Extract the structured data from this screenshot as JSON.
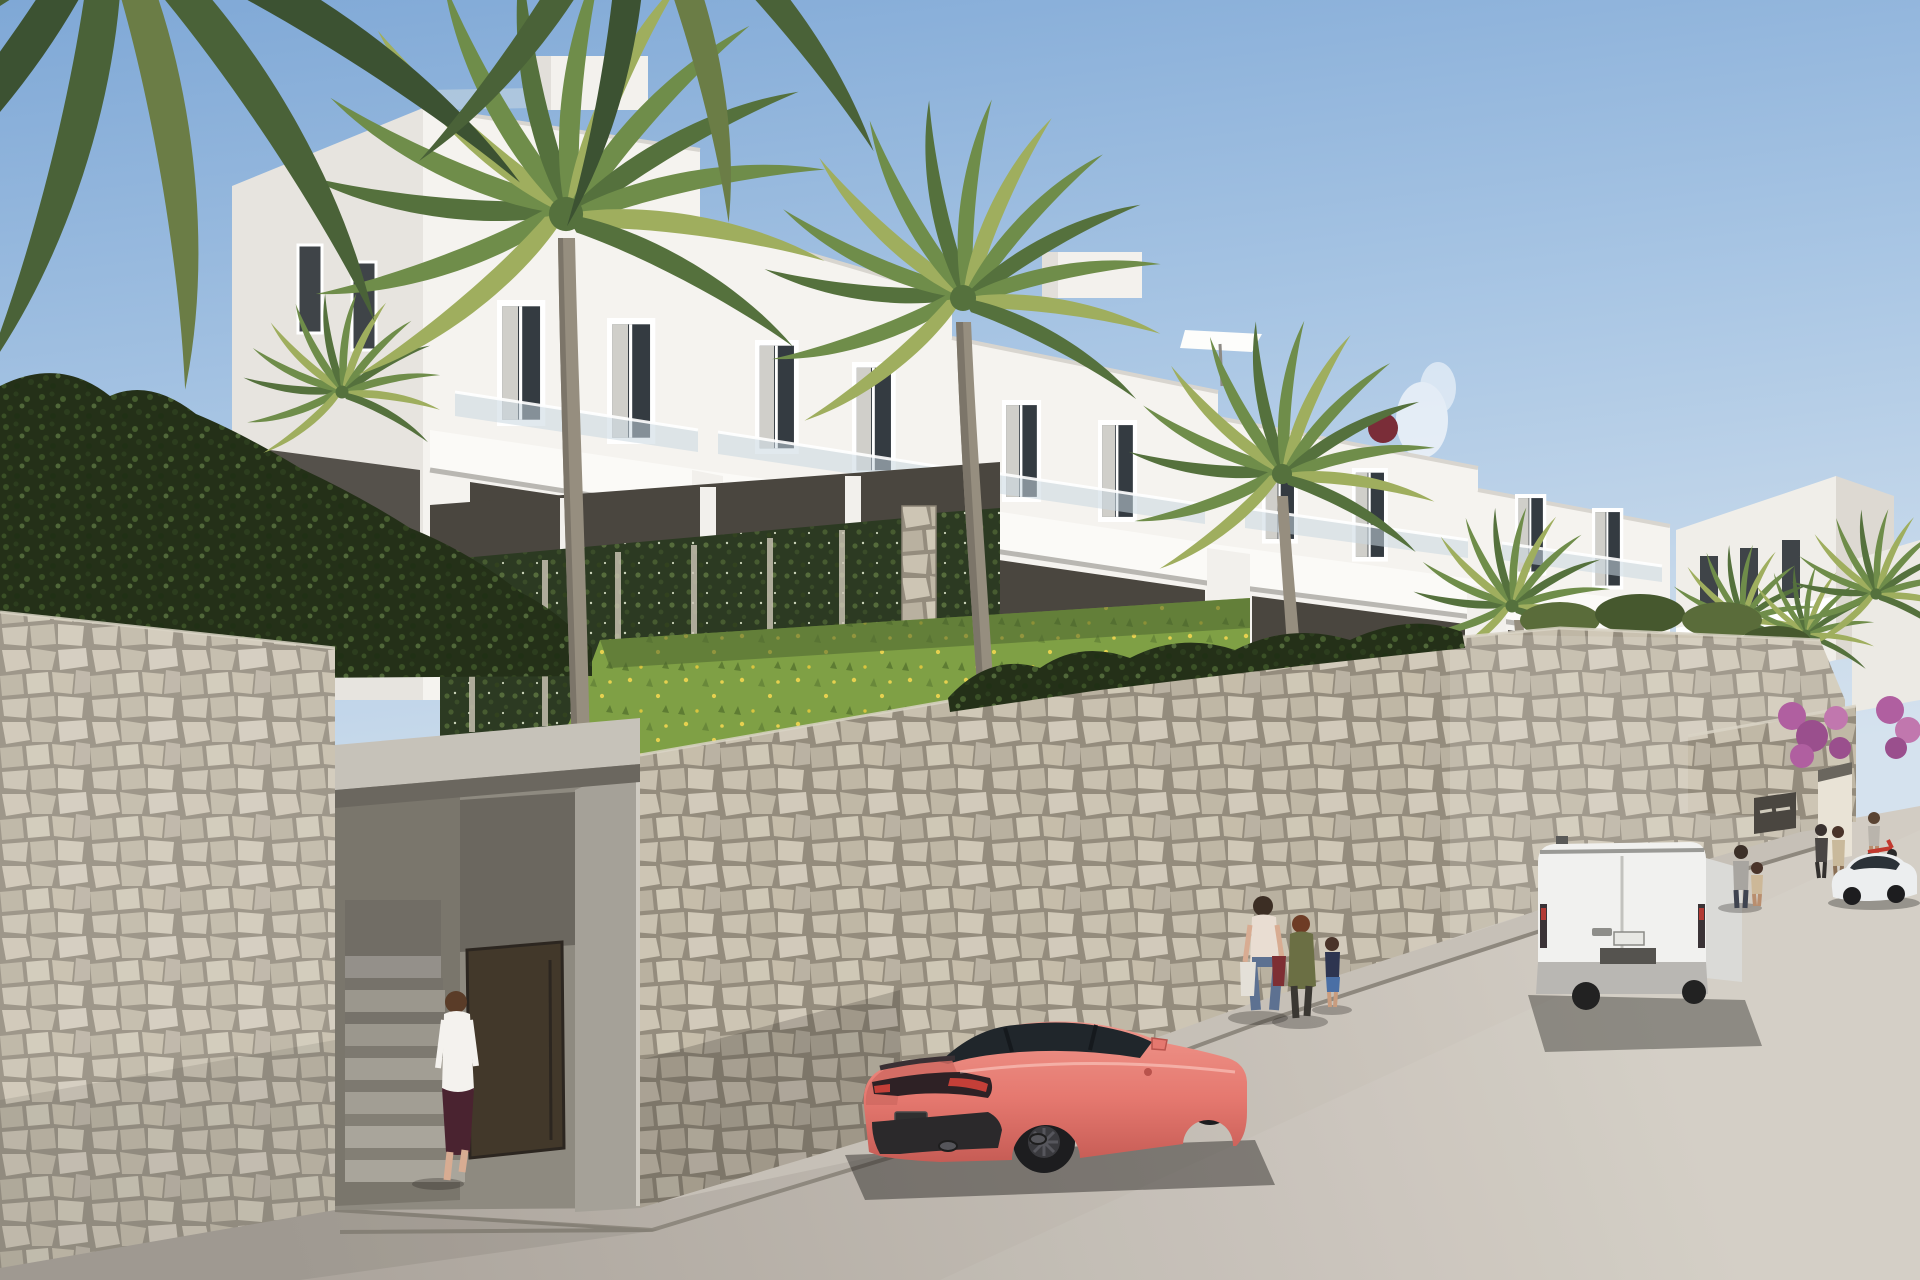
{
  "scene_type": "architectural-exterior-render",
  "colors": {
    "sky_top": "#7fa8d6",
    "sky_mid": "#a9c6e4",
    "sky_low": "#d5e2ee",
    "building_sun": "#f5f3ef",
    "building_shade": "#e7e4df",
    "building_recess": "#4a463f",
    "parapet": "#fbfaf7",
    "glass_balustrade": "#c9d7e0",
    "window_glass": "#343b41",
    "window_frame": "#ffffff",
    "curtain": "#eceae3",
    "stone_light": "#c9c1b0",
    "stone_grout": "#948c7d",
    "hedge": "#243018",
    "ivy": "#2c3a22",
    "grass": "#7fa045",
    "wildflower": "#e6d14f",
    "palm_green": "#6f8d4a",
    "palm_dark": "#4a6238",
    "palm_light": "#9fae5e",
    "palm_trunk": "#968e7f",
    "road_near": "#aba49c",
    "road_far": "#d2ccc3",
    "sidewalk": "#c6c0b7",
    "curb": "#8e887e",
    "car_body": "#ef978c",
    "car_body_dark": "#c55b54",
    "car_glass": "#20262b",
    "wheel": "#1d1d1f",
    "tail_light_red": "#c43f38",
    "van_body": "#f1f1ef",
    "van_side": "#dadad7",
    "van_bumper": "#b9b7b3",
    "sedan_body": "#eceeef",
    "door_brown": "#42382a",
    "bougainvillea": "#b05fa0",
    "scooter_red": "#c2392f",
    "skirt_maroon": "#4a2330",
    "jeans_blue": "#5d7191",
    "jacket_olive": "#6b6f44",
    "shorts_blue": "#4a6fa5"
  },
  "objects": {
    "architecture": [
      "white-apartment-complex",
      "roof-terraces",
      "stone-retaining-wall",
      "stairwell-entrance",
      "brown-entry-door",
      "ivy-trellis",
      "distant-white-buildings",
      "far-gate-opening",
      "wall-sign-plaque"
    ],
    "vehicles": [
      "coral-sports-coupe",
      "white-panel-van",
      "white-sedan",
      "red-scooter"
    ],
    "figures": [
      "woman-entering-stairwell",
      "woman-with-shopping-bags",
      "woman-in-olive-jacket",
      "child-in-blue-shorts",
      "man-with-child",
      "people-at-far-gate",
      "scooter-rider"
    ],
    "landscape": [
      "palm-trees",
      "overhanging-palm-fronds",
      "dark-hedges",
      "lawn-with-wildflowers",
      "bougainvillea",
      "blue-sky",
      "small-cloud"
    ]
  }
}
